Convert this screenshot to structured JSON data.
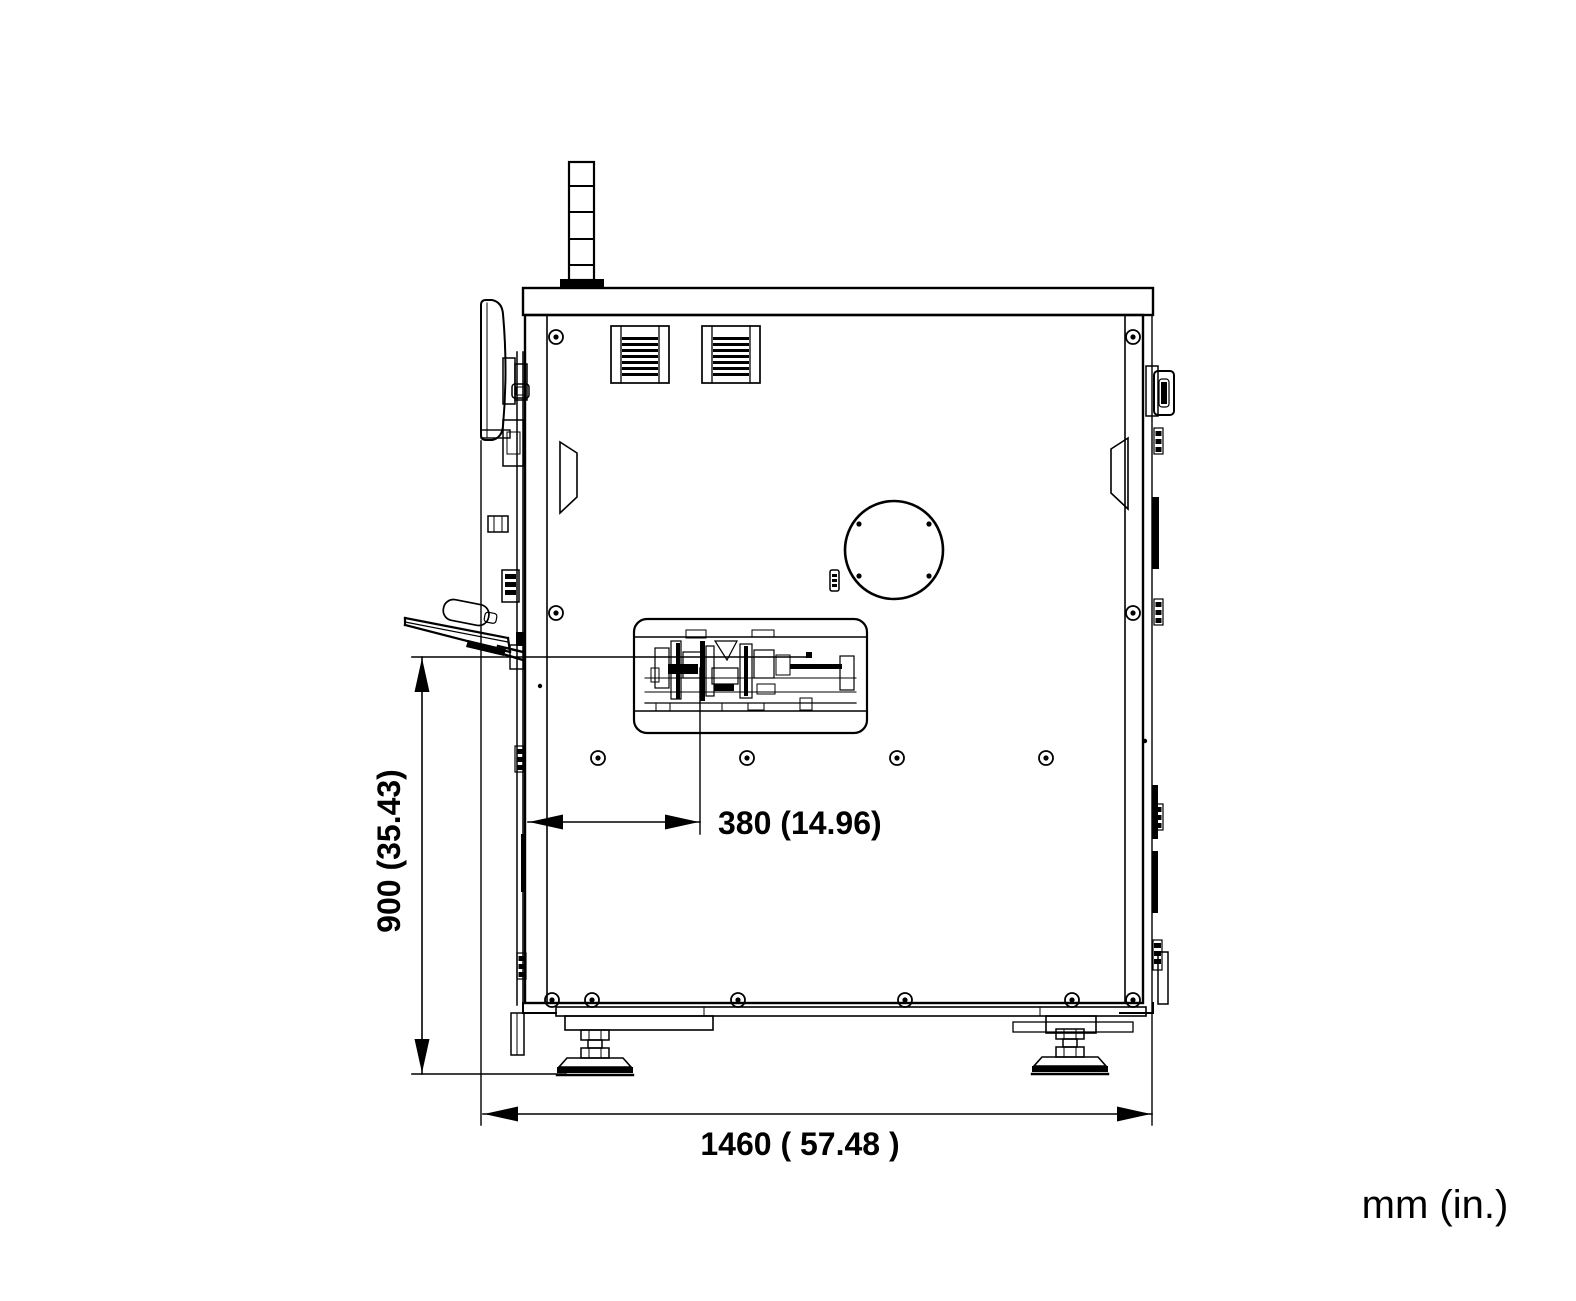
{
  "drawing": {
    "units_label": "mm (in.)",
    "dimensions": {
      "overall_width": {
        "label": "1460 ( 57.48 )",
        "mm": 1460,
        "inches": 57.48,
        "orientation": "horizontal"
      },
      "work_height": {
        "label": "900 (35.43)",
        "mm": 900,
        "inches": 35.43,
        "orientation": "vertical"
      },
      "feed_offset": {
        "label": "380 (14.96)",
        "mm": 380,
        "inches": 14.96,
        "orientation": "horizontal"
      }
    },
    "colors": {
      "line": "#000000",
      "background": "#ffffff"
    }
  }
}
